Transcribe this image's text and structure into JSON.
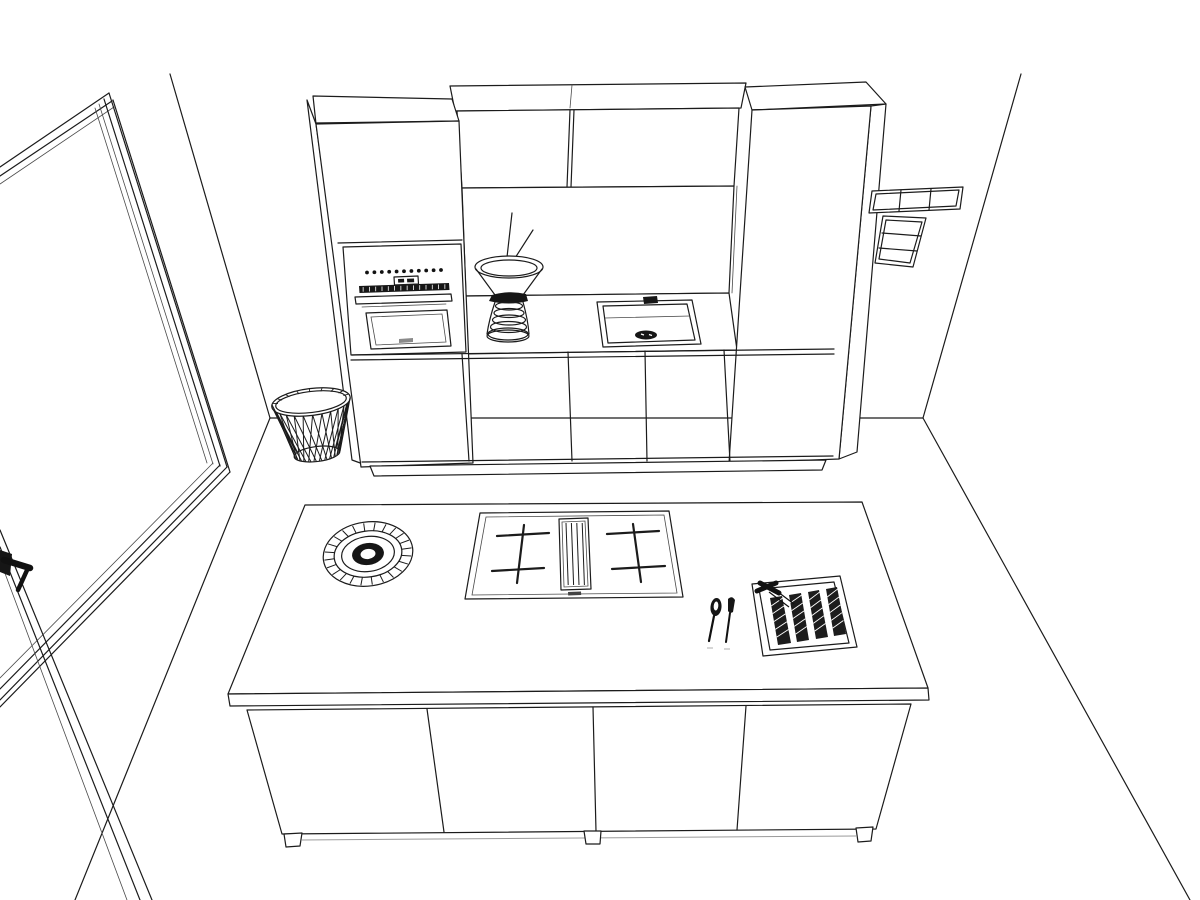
{
  "meta": {
    "title": "Kitchen 3D line-art rendering",
    "description": "Black-and-white perspective line drawing of a kitchen: a tall cabinet wall with built-in oven, sink niche with vase, wall cabinets, a floor-to-ceiling glazed door on the left, switch panels on the right wall, a slatted waste basket, and a kitchen island with hob, downdraft vent, decorative bowl, cutlery and a knife tray.",
    "background_color": "#ffffff",
    "line_color": "#1b1b1b",
    "dark_fill_color": "#161616"
  },
  "room": {
    "walls_label": "Room corner walls and floor lines",
    "left_opening_label": "Floor-to-ceiling glazed door",
    "door_handle_label": "Lever door handle"
  },
  "cabinet_wall": {
    "label": "Tall cabinet run with sink niche",
    "tall_cabinet_left_label": "Tall housing with built-in oven",
    "tall_cabinet_right_label": "Tall cabinet",
    "upper_cabinets": {
      "label": "Wall cabinets above niche",
      "door_count": 2
    },
    "base_cabinets": {
      "label": "Base cabinets below counter",
      "door_count": 3
    },
    "oven": {
      "label": "Built-in oven with control dots, display and bar handle",
      "control_dot_count": 11,
      "strip_tick_count": 14
    },
    "counter_label": "Niche countertop",
    "sink": {
      "label": "Square sink with drain and tap fitting"
    },
    "vase": {
      "label": "Ribbed hourglass vase with twigs",
      "rib_count": 5
    }
  },
  "switch_panel": {
    "label": "Wall switch panels",
    "horizontal_row_cells": 3,
    "vertical_column_cells": 3
  },
  "wastebasket": {
    "label": "Slatted waste basket",
    "slat_count": 15,
    "rim_spoke_count": 9
  },
  "island": {
    "label": "Kitchen island with four door fronts",
    "door_count": 4,
    "foot_count": 3,
    "worktop_items": [
      "decorative bowl",
      "hob with central downdraft vent",
      "spoon",
      "paring knife",
      "knife tray insert"
    ],
    "bowl": {
      "label": "Round decorative bowl with patterned rim",
      "spoke_count": 24
    },
    "hob": {
      "label": "Hob with two cross-marked cooking zones and downdraft vent",
      "burner_zone_count": 2,
      "vent_slat_count": 4
    },
    "spoon_label": "Spoon",
    "knife_label": "Paring knife",
    "knife_tray": {
      "label": "Knife tray insert",
      "slot_count": 4,
      "hatch_lines_per_slot": 5
    }
  }
}
